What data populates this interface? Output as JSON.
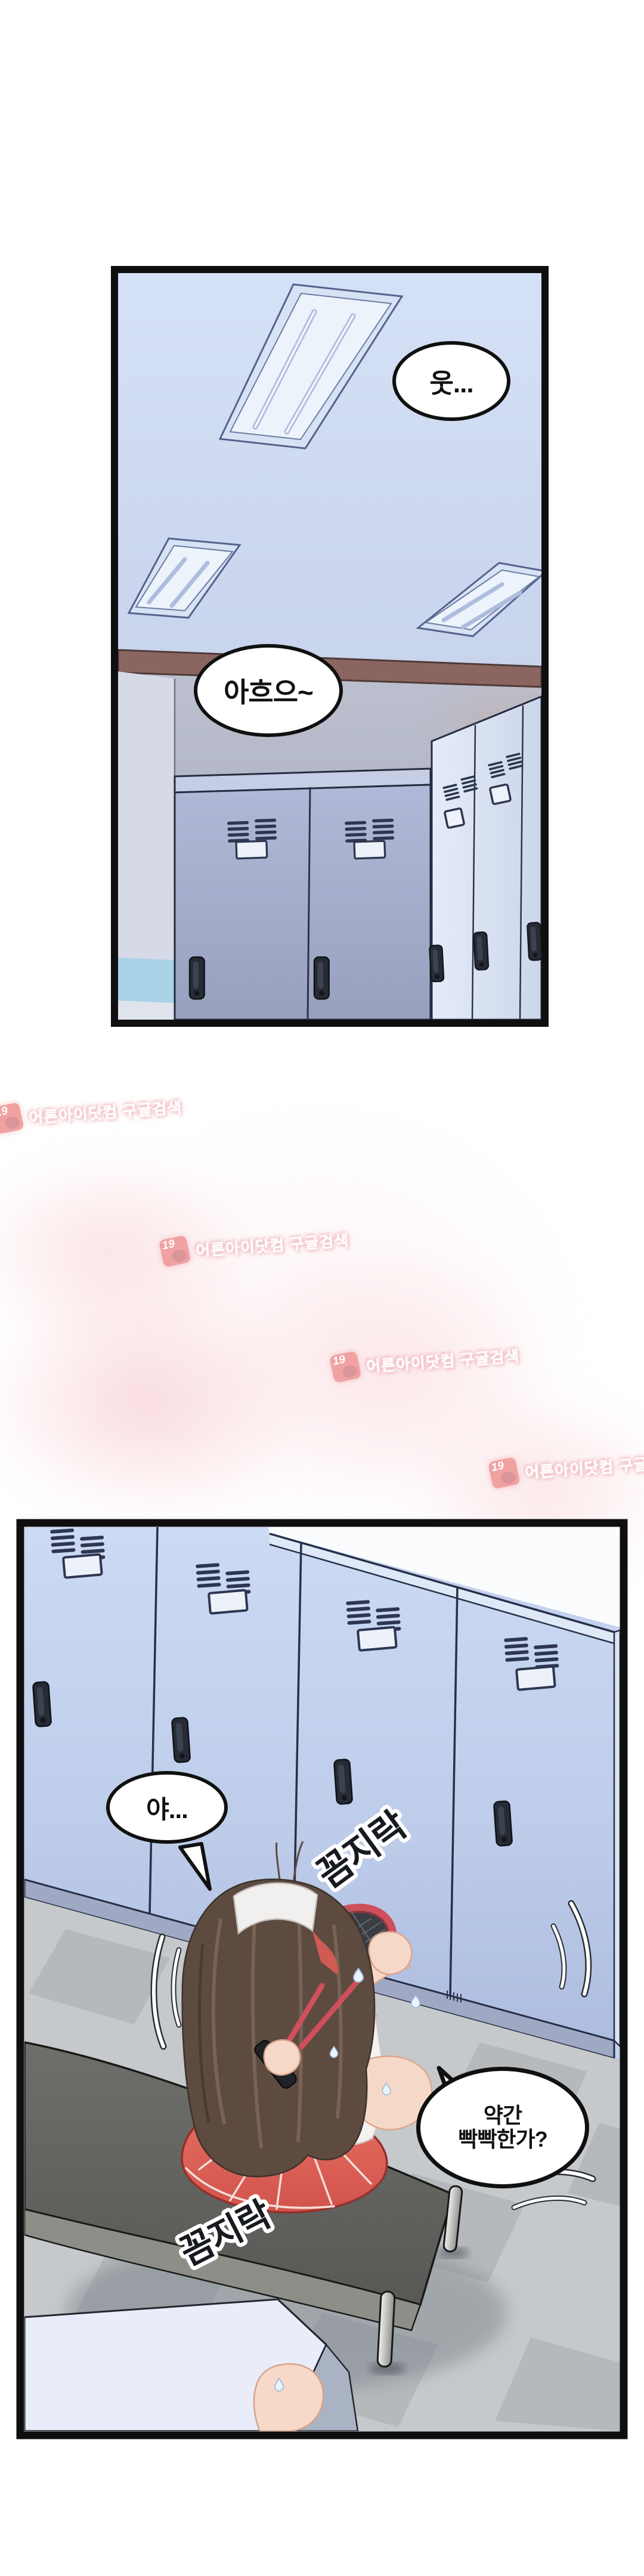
{
  "bubbles": {
    "b1": "웃...",
    "b2": "아흐으~",
    "b3": "야...",
    "b4_line1": "약간",
    "b4_line2": "빡빡한가?"
  },
  "sfx": {
    "s1": "꼼지락",
    "s2": "꼼지락"
  },
  "watermark": {
    "badge": "19",
    "text": "어른아이닷컴 구글검색"
  },
  "colors": {
    "panel_border": "#0f0f0f",
    "ceiling_blue": "#cfdcf3",
    "locker_blue": "#c5d4f0",
    "locker_gray_blue": "#aab4d2",
    "trim_brown": "#8b6560",
    "bench_gray": "#64645f",
    "floor_gray": "#c6c9cb",
    "floor_tile_dark": "#b1b6ba",
    "skirt_red": "#e2655b",
    "racket_red": "#d25059",
    "hair_brown": "#5d4b40",
    "watermark_pink": "#f0a0a0",
    "bubble_bg": "#ffffff"
  }
}
